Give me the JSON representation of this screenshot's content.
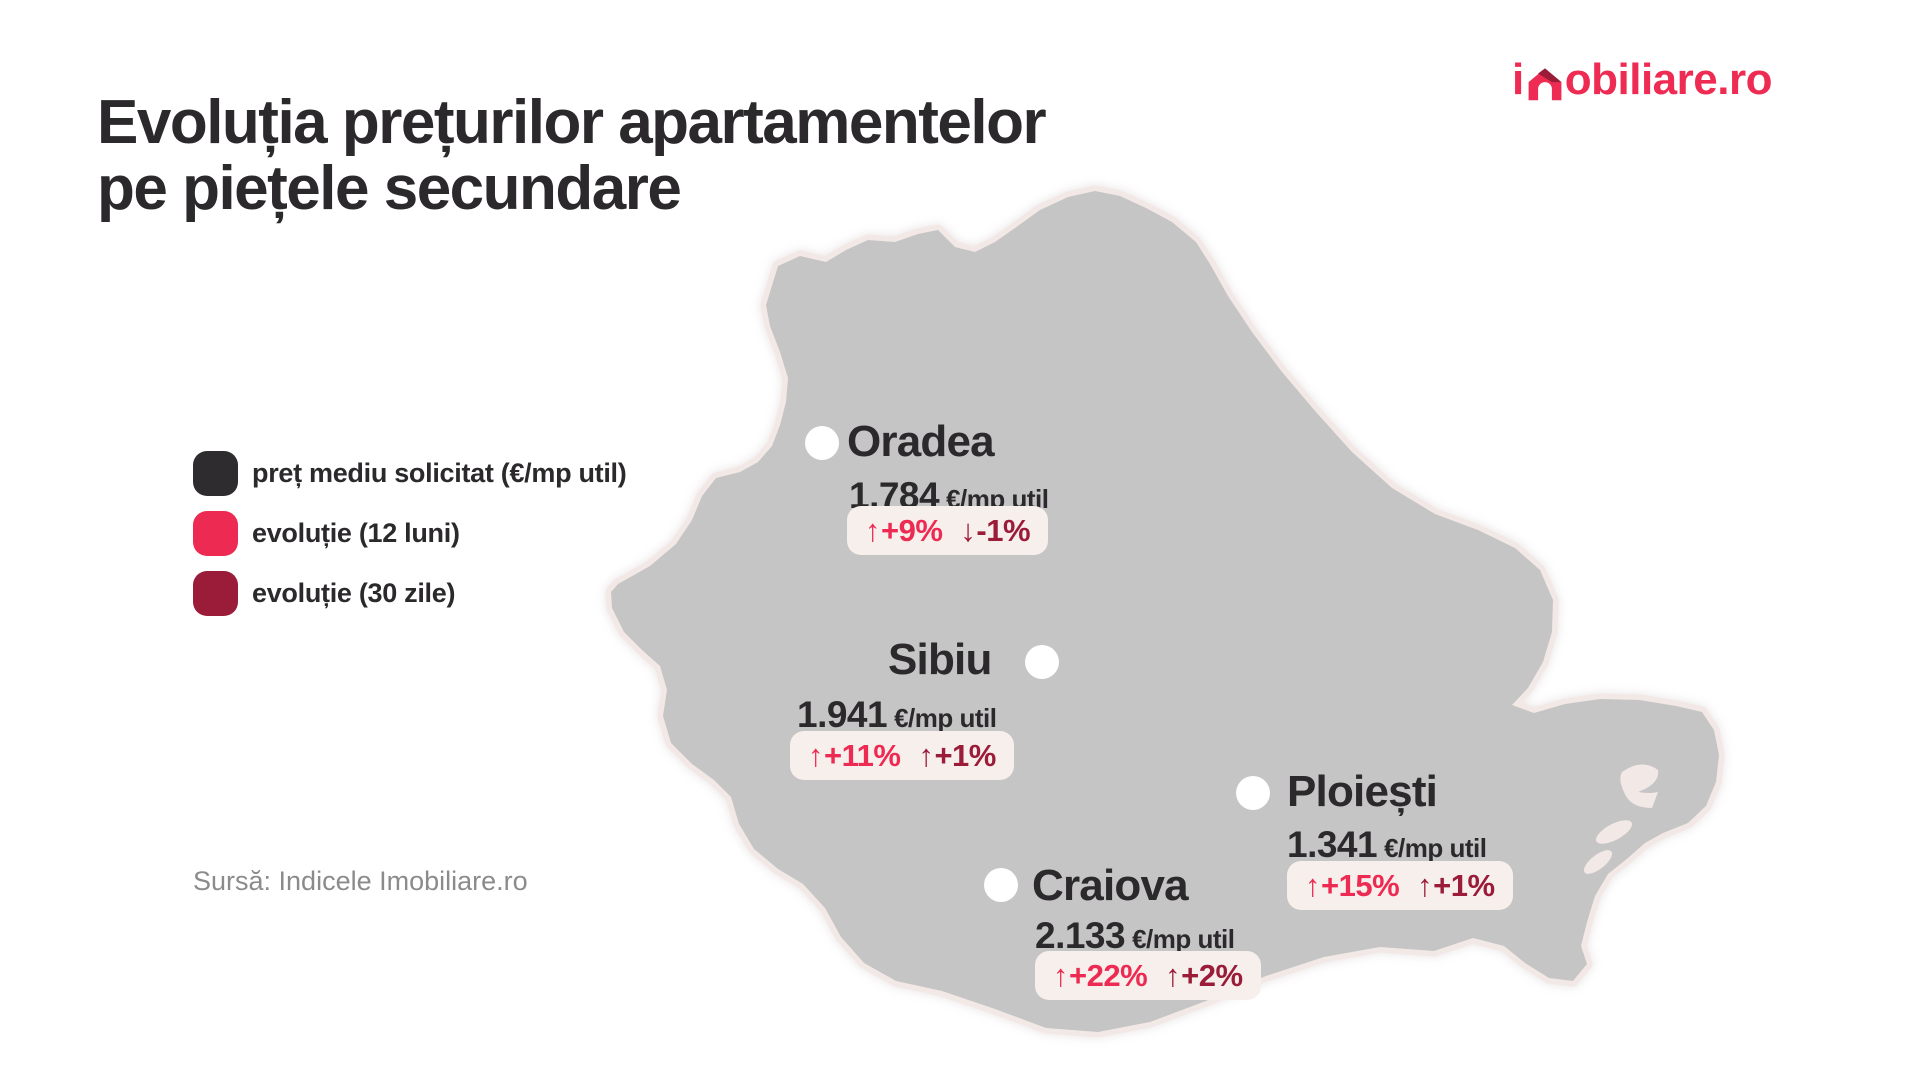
{
  "page": {
    "background": "#ffffff"
  },
  "logo": {
    "full_text": "imobiliare.ro",
    "prefix": "i",
    "suffix": "obiliare.ro",
    "color": "#ee2b52",
    "house_dark": "#9b1c38"
  },
  "title": {
    "line1": "Evoluția prețurilor apartamentelor",
    "line2": "pe piețele secundare",
    "color": "#2b292b"
  },
  "legend": {
    "items": [
      {
        "label": "preț mediu solicitat (€/mp util)",
        "color": "#2e2c2e"
      },
      {
        "label": "evoluție (12 luni)",
        "color": "#ed2b52"
      },
      {
        "label": "evoluție (30 zile)",
        "color": "#9b1c38"
      }
    ]
  },
  "map": {
    "region": "Romania",
    "fill": "#c6c5c5",
    "outline": "#f2e9e6"
  },
  "cities": [
    {
      "name": "Oradea",
      "price": "1.784",
      "unit": "€/mp util",
      "evo12": {
        "arrow": "↑",
        "value": "+9%"
      },
      "evo30": {
        "arrow": "↓",
        "value": "-1%"
      }
    },
    {
      "name": "Sibiu",
      "price": "1.941",
      "unit": "€/mp util",
      "evo12": {
        "arrow": "↑",
        "value": "+11%"
      },
      "evo30": {
        "arrow": "↑",
        "value": "+1%"
      }
    },
    {
      "name": "Ploiești",
      "price": "1.341",
      "unit": "€/mp util",
      "evo12": {
        "arrow": "↑",
        "value": "+15%"
      },
      "evo30": {
        "arrow": "↑",
        "value": "+1%"
      }
    },
    {
      "name": "Craiova",
      "price": "2.133",
      "unit": "€/mp util",
      "evo12": {
        "arrow": "↑",
        "value": "+22%"
      },
      "evo30": {
        "arrow": "↑",
        "value": "+2%"
      }
    }
  ],
  "source": {
    "text": "Sursă: Indicele Imobiliare.ro"
  },
  "chart_data": {
    "type": "table",
    "title": "Evoluția prețurilor apartamentelor pe piețele secundare",
    "categories": [
      "Oradea",
      "Sibiu",
      "Ploiești",
      "Craiova"
    ],
    "series": [
      {
        "name": "preț mediu solicitat (€/mp util)",
        "values": [
          1784,
          1941,
          1341,
          2133
        ]
      },
      {
        "name": "evoluție (12 luni)",
        "values": [
          "+9%",
          "+11%",
          "+15%",
          "+22%"
        ]
      },
      {
        "name": "evoluție (30 zile)",
        "values": [
          "-1%",
          "+1%",
          "+1%",
          "+2%"
        ]
      }
    ]
  }
}
